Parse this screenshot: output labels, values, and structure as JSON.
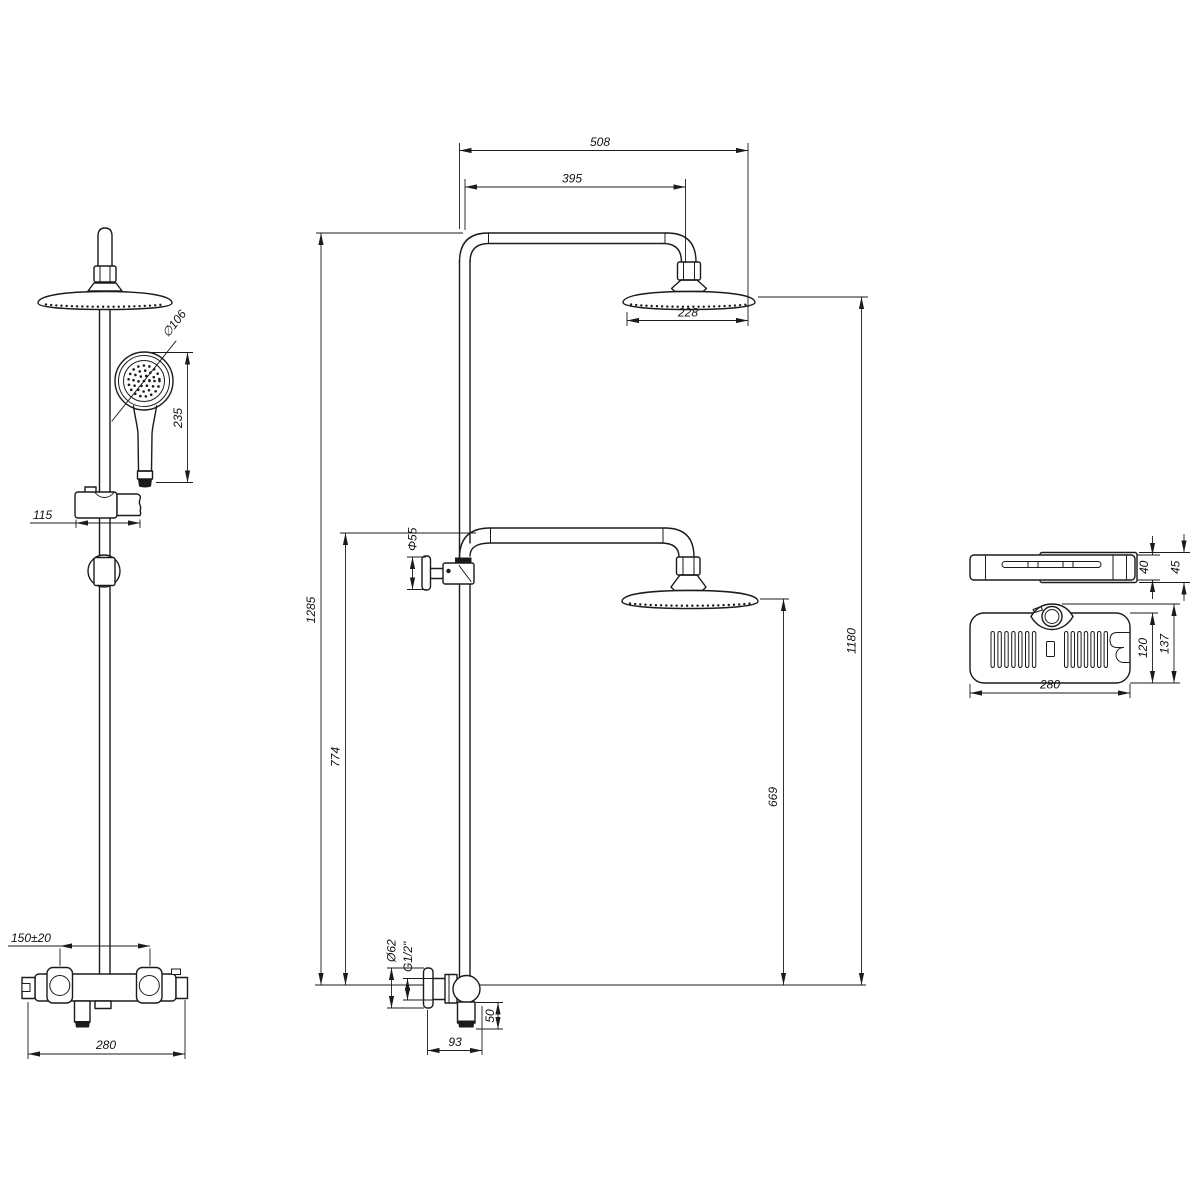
{
  "colors": {
    "ink": "#1b1b1b",
    "background": "#ffffff"
  },
  "front_view": {
    "handheld_diameter": "∅106",
    "handheld_length": "235",
    "slider_bracket_width": "115",
    "inlet_spacing": "150±20",
    "mixer_width": "280"
  },
  "side_view": {
    "overall_reach": "508",
    "arm_reach": "395",
    "head_diameter": "228",
    "riser_height": "1285",
    "lower_outlet_height": "774",
    "bracket_diameter": "Φ55",
    "upper_head_height": "1180",
    "lower_head_height": "669",
    "escutcheon_diameter": "Ø62",
    "thread_size": "G1/2\"",
    "spout_drop": "50",
    "spout_reach": "93"
  },
  "shelf_view": {
    "front_height": "40",
    "back_height": "45",
    "tray_depth": "120",
    "overall_depth": "137",
    "tray_width": "280"
  }
}
